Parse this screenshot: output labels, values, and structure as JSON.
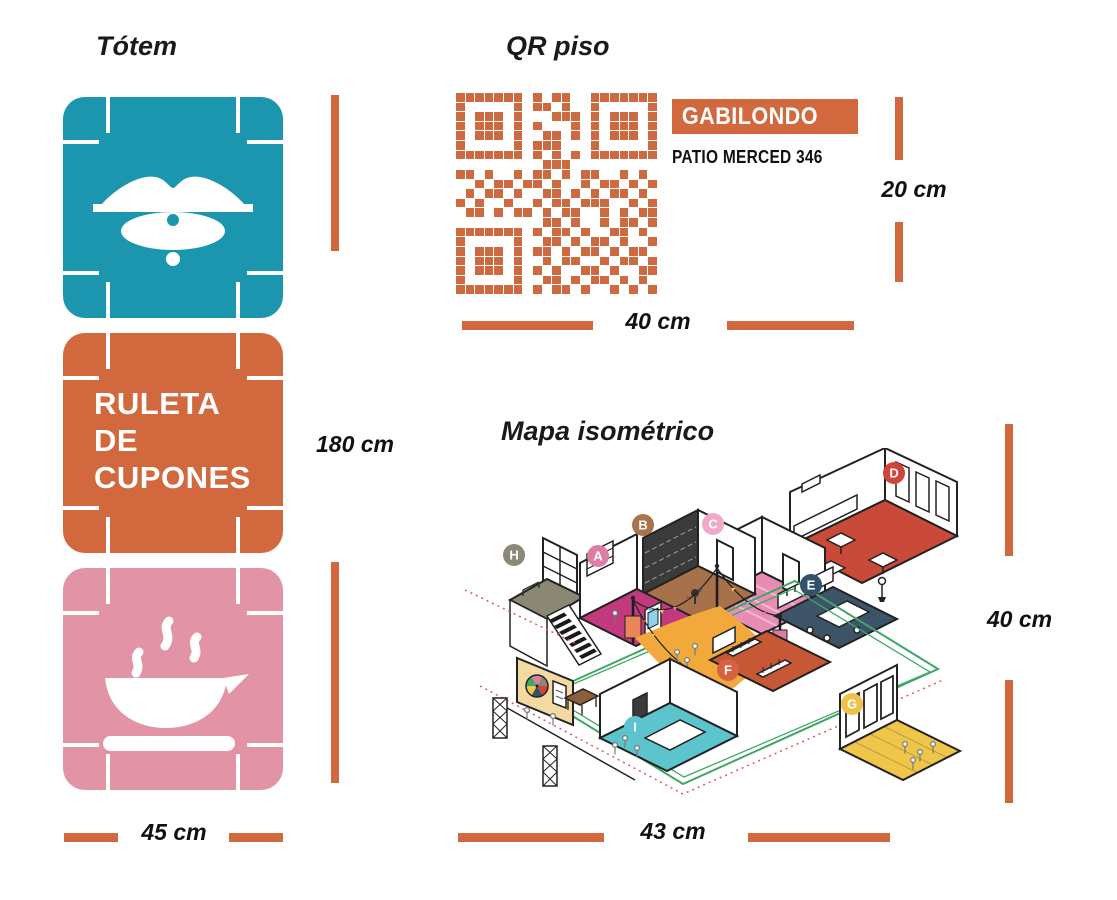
{
  "colors": {
    "accent_orange": "#D2693E",
    "qr_orange": "#CD6A3F",
    "panel_teal": "#1C96AE",
    "panel_orange": "#D2693E",
    "panel_pink": "#E294A6",
    "text_black": "#1a1a1a"
  },
  "totem": {
    "title": "Tótem",
    "panel_lips": {
      "icon": "lips-piercing-icon",
      "color": "#1C96AE"
    },
    "panel_ruleta": {
      "color": "#D2693E",
      "line1": "RULETA",
      "line2": "DE",
      "line3": "CUPONES"
    },
    "panel_coffee": {
      "icon": "coffee-cup-icon",
      "color": "#E294A6"
    },
    "height_label": "180 cm",
    "width_label": "45 cm"
  },
  "qr": {
    "title": "QR piso",
    "store_name": "GABILONDO",
    "store_address": "PATIO MERCED 346",
    "height_label": "20 cm",
    "width_label": "40 cm",
    "matrix": [
      "111111101011001111111",
      "100000101101001000001",
      "101110100011101011101",
      "101110101000101011101",
      "101110100110101011101",
      "100000101110001000001",
      "111111101010101111111",
      "000000000111000000000",
      "110100101101011001010",
      "001011011010010110101",
      "010110100110101011010",
      "101001001011011100101",
      "011010110101100101011",
      "000000000110100101101",
      "111111101011010011010",
      "100000100110101101001",
      "101110101101011010110",
      "101110100101100101101",
      "101110101010011010011",
      "100000100110101101010",
      "111111101011010010101"
    ]
  },
  "map": {
    "title": "Mapa isométrico",
    "height_label": "40 cm",
    "width_label": "43 cm",
    "markers": [
      {
        "label": "A",
        "color": "#DD7DA5"
      },
      {
        "label": "B",
        "color": "#A8744C"
      },
      {
        "label": "C",
        "color": "#F0A9C6"
      },
      {
        "label": "D",
        "color": "#D04439"
      },
      {
        "label": "E",
        "color": "#33516B"
      },
      {
        "label": "F",
        "color": "#D96140"
      },
      {
        "label": "G",
        "color": "#EFC04A"
      },
      {
        "label": "H",
        "color": "#8C8876"
      },
      {
        "label": "I",
        "color": "#5BC4D0"
      }
    ]
  }
}
